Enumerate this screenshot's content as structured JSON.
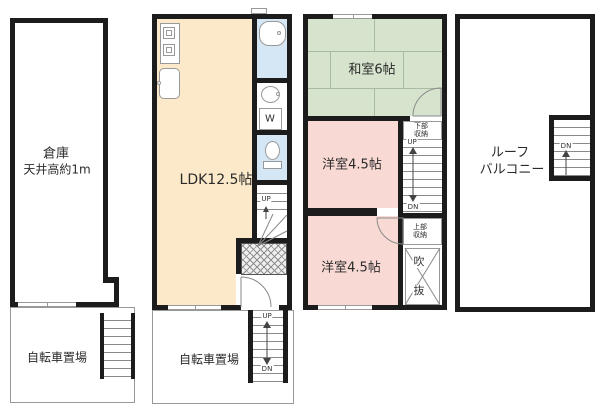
{
  "colors": {
    "wall": "#1c1c1c",
    "cream": "#fbe9c9",
    "green": "#d6e3cd",
    "pink": "#f8d9d4",
    "blue": "#d5e7f5",
    "line": "#8a8a8a"
  },
  "floor1": {
    "warehouse_label": "倉庫",
    "warehouse_sublabel": "天井高約1m",
    "bicycle_label": "自転車置場"
  },
  "floor2": {
    "ldk_label": "LDK12.5帖",
    "washer_label": "W",
    "entry_stairs_up": "UP",
    "bicycle_label": "自転車置場",
    "outdoor_stairs_up": "UP",
    "outdoor_stairs_dn": "DN"
  },
  "floor3": {
    "washitsu_label": "和室6帖",
    "bedroom1_label": "洋室4.5帖",
    "bedroom2_label": "洋室4.5帖",
    "storage_lower_line1": "下部",
    "storage_lower_line2": "収納",
    "storage_upper_line1": "上部",
    "storage_upper_line2": "収納",
    "stairs_up": "UP",
    "stairs_dn": "DN",
    "void_line1": "吹",
    "void_line2": "抜"
  },
  "roof": {
    "label_line1": "ルーフ",
    "label_line2": "バルコニー",
    "stairs_dn": "DN"
  }
}
